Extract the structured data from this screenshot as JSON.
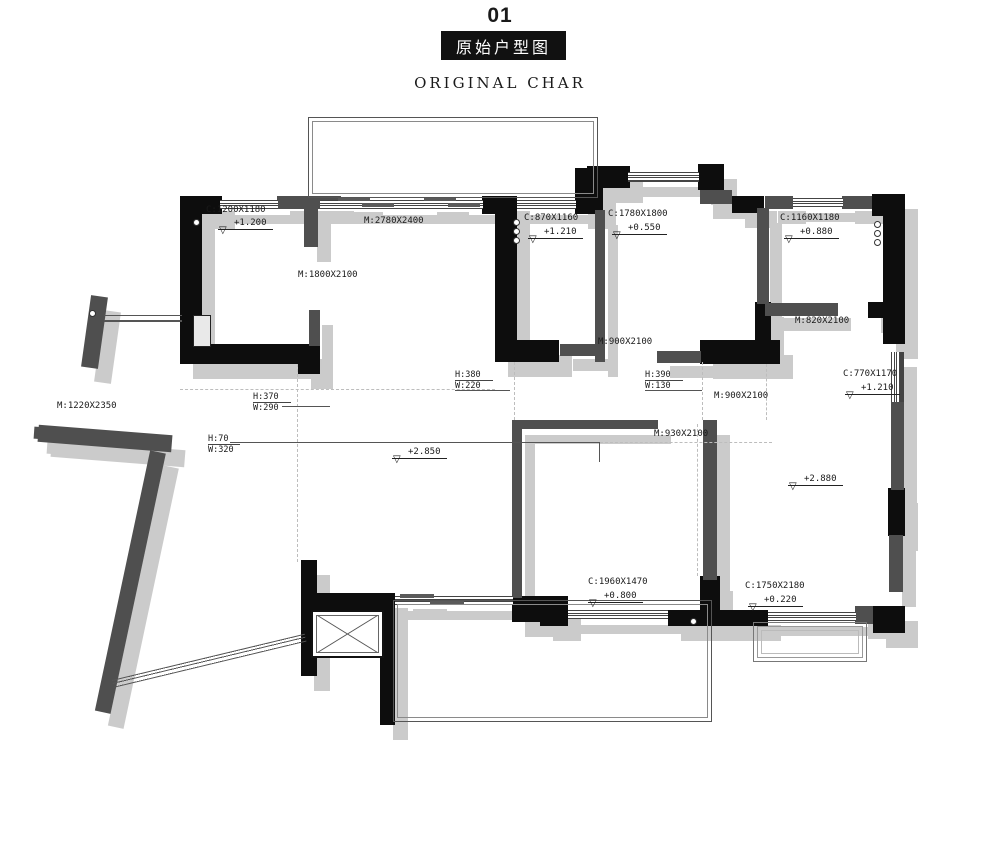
{
  "title": {
    "number": "01",
    "name_cn": "原始户型图",
    "name_en": "ORIGINAL CHAR"
  },
  "plan": {
    "labels": {
      "c1200": "C:1200X1180",
      "m2780": "M:2780X2400",
      "m1800": "M:1800X2100",
      "c870": "C:870X1160",
      "c1780": "C:1780X1800",
      "c1160": "C:1160X1180",
      "m820": "M:820X2100",
      "m900a": "M:900X2100",
      "m900b": "M:900X2100",
      "c770": "C:770X1170",
      "m1220": "M:1220X2350",
      "m930": "M:930X2100",
      "c1960": "C:1960X1470",
      "c1750": "C:1750X2180"
    },
    "levels": {
      "l1200": "+1.200",
      "l1210a": "+1.210",
      "l0550": "+0.550",
      "l0880": "+0.880",
      "l1210b": "+1.210",
      "l2850": "+2.850",
      "l2880": "+2.880",
      "l0800": "+0.800",
      "l0220": "+0.220"
    },
    "dims": {
      "d1": {
        "h": "H:380",
        "w": "W:220"
      },
      "d2": {
        "h": "H:390",
        "w": "W:130"
      },
      "d3": {
        "h": "H:370",
        "w": "W:290"
      },
      "d4": {
        "h": "H:70",
        "w": "W:320"
      }
    }
  },
  "colors": {
    "wall_black": "#0d0d0d",
    "wall_gray": "#4f4f4f",
    "shadow": "#cbcbcb",
    "line": "#3a3a3a",
    "dashed": "#bdbdbd",
    "title_bg": "#111111"
  }
}
